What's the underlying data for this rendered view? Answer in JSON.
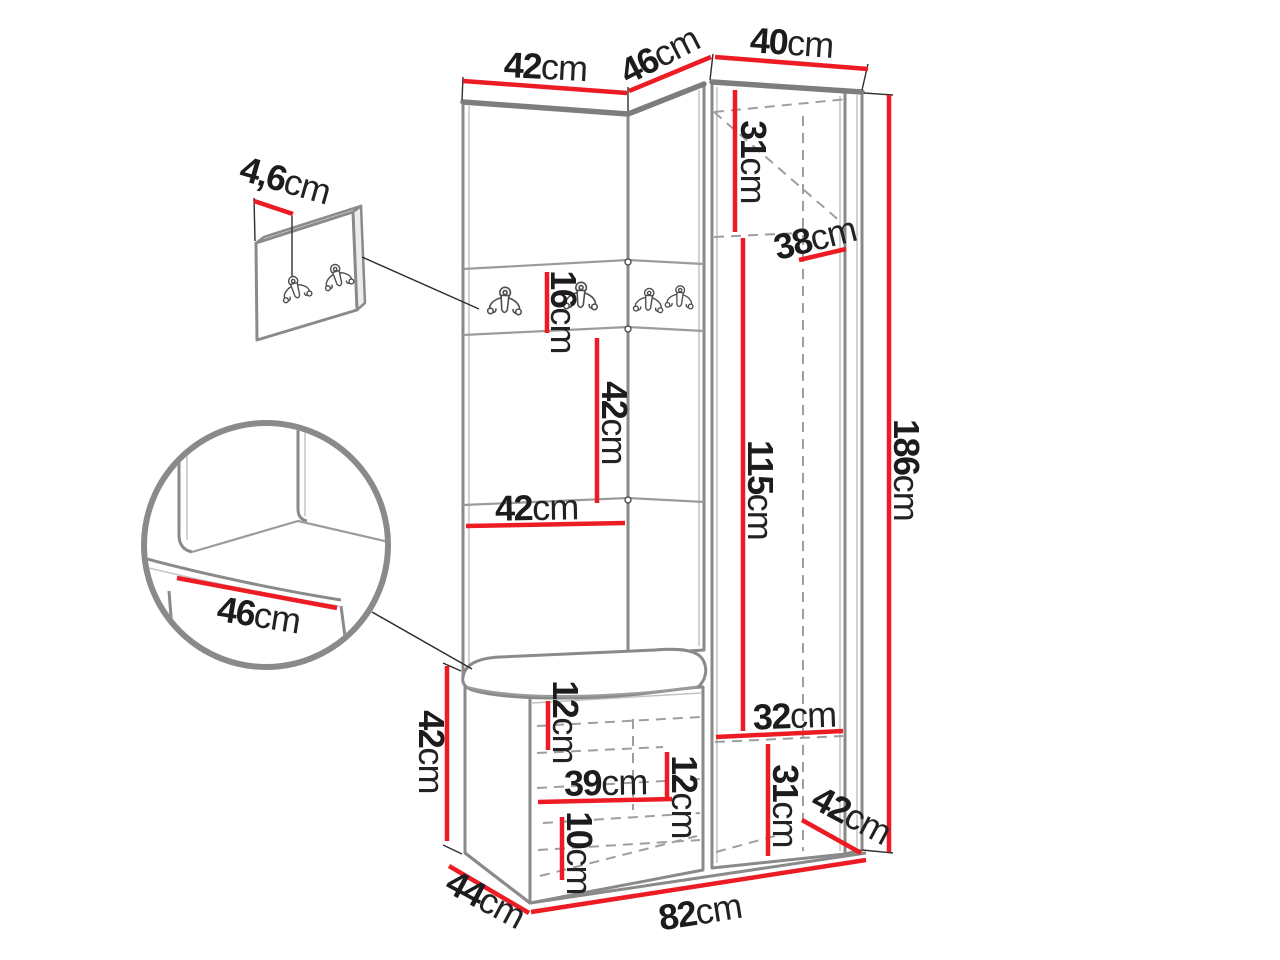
{
  "diagram": {
    "type": "furniture-dimension-diagram",
    "unit_suffix": "cm",
    "colors": {
      "dimension_line": "#ed1c24",
      "outline": "#8a8a8a",
      "label_text": "#1c1c1e",
      "background": "#ffffff"
    },
    "dims": {
      "top_42": {
        "value": "42",
        "unit": "cm"
      },
      "top_46": {
        "value": "46",
        "unit": "cm"
      },
      "top_40": {
        "value": "40",
        "unit": "cm"
      },
      "hook_panel_4_6": {
        "value": "4,6",
        "unit": "cm"
      },
      "rail_16": {
        "value": "16",
        "unit": "cm"
      },
      "panel_42_v": {
        "value": "42",
        "unit": "cm"
      },
      "panel_42_h": {
        "value": "42",
        "unit": "cm"
      },
      "cab_31_top": {
        "value": "31",
        "unit": "cm"
      },
      "cab_38": {
        "value": "38",
        "unit": "cm"
      },
      "cab_115": {
        "value": "115",
        "unit": "cm"
      },
      "total_186": {
        "value": "186",
        "unit": "cm"
      },
      "seat_46": {
        "value": "46",
        "unit": "cm"
      },
      "bench_42": {
        "value": "42",
        "unit": "cm"
      },
      "bench_12_top": {
        "value": "12",
        "unit": "cm"
      },
      "bench_39": {
        "value": "39",
        "unit": "cm"
      },
      "bench_12_right": {
        "value": "12",
        "unit": "cm"
      },
      "bench_10": {
        "value": "10",
        "unit": "cm"
      },
      "bench_44": {
        "value": "44",
        "unit": "cm"
      },
      "total_82": {
        "value": "82",
        "unit": "cm"
      },
      "cab_32": {
        "value": "32",
        "unit": "cm"
      },
      "cab_31_bottom": {
        "value": "31",
        "unit": "cm"
      },
      "cab_42_depth": {
        "value": "42",
        "unit": "cm"
      }
    }
  }
}
